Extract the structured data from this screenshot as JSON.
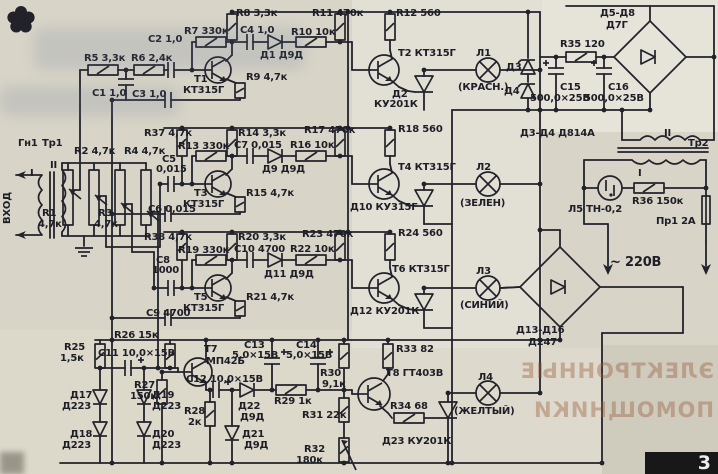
{
  "page": {
    "page_number": "3",
    "corner_icon": "flower-asterisk-icon",
    "paper_color": "#d8d4c7",
    "ink_color": "#22222b",
    "ghost": [
      "ЭЛЕКТРОННЫЕ",
      "ПОМОЩНИКИ"
    ]
  },
  "schematic": {
    "type": "hand-drawn color-music device circuit",
    "lamps": [
      {
        "name": "Л1",
        "color": "(КРАСН.)"
      },
      {
        "name": "Л2",
        "color": "(ЗЕЛЕН)"
      },
      {
        "name": "Л3",
        "color": "(СИНИЙ)"
      },
      {
        "name": "Л4",
        "color": "(ЖЕЛТЫЙ)"
      },
      {
        "name": "Л5",
        "type_label": "ТН-0,2"
      }
    ],
    "labels": [
      [
        "Гн1",
        18,
        146
      ],
      [
        "Тр1",
        42,
        146
      ],
      [
        "ВХОД",
        10,
        224,
        10,
        -90
      ],
      [
        "I",
        30,
        176
      ],
      [
        "II",
        50,
        168
      ],
      [
        "R1",
        42,
        216
      ],
      [
        "4,7к",
        38,
        227
      ],
      [
        "R2 4,7к",
        74,
        154
      ],
      [
        "R3",
        98,
        216
      ],
      [
        "4,7к",
        94,
        227
      ],
      [
        "R4 4,7к",
        124,
        154
      ],
      [
        "R5 3,3к",
        84,
        61
      ],
      [
        "R6 2,4к",
        131,
        61
      ],
      [
        "С1 1,0",
        92,
        96
      ],
      [
        "С2 1,0",
        148,
        42
      ],
      [
        "С3 1,0",
        132,
        97
      ],
      [
        "R7 330к",
        184,
        34
      ],
      [
        "Т1",
        194,
        82
      ],
      [
        "КТ315Г",
        183,
        93
      ],
      [
        "R8 3,3к",
        236,
        16
      ],
      [
        "С4 1,0",
        240,
        33
      ],
      [
        "Д1 Д9Д",
        260,
        58
      ],
      [
        "R10 10к",
        291,
        35
      ],
      [
        "R9 4,7к",
        246,
        80
      ],
      [
        "R11 470к",
        312,
        16
      ],
      [
        "R12 560",
        396,
        16
      ],
      [
        "Т2 КТ315Г",
        398,
        56
      ],
      [
        "Д2",
        392,
        97
      ],
      [
        "КУ201К",
        374,
        107
      ],
      [
        "Л1",
        476,
        56
      ],
      [
        "(КРАСН.)",
        458,
        90
      ],
      [
        "Д3",
        506,
        70
      ],
      [
        "Д4",
        504,
        94
      ],
      [
        "Д5-Д8",
        600,
        16
      ],
      [
        "Д7Г",
        606,
        28
      ],
      [
        "R35 120",
        560,
        47
      ],
      [
        "С15",
        560,
        90
      ],
      [
        "500,0×25В",
        530,
        101
      ],
      [
        "С16",
        608,
        90
      ],
      [
        "500,0×25В",
        584,
        101
      ],
      [
        "Д3-Д4 Д814А",
        520,
        136
      ],
      [
        "R37 4,7к",
        144,
        136
      ],
      [
        "R13 330к",
        178,
        149
      ],
      [
        "R14 3,3к",
        238,
        136
      ],
      [
        "С5",
        162,
        162
      ],
      [
        "0,015",
        156,
        172
      ],
      [
        "С7 0,015",
        234,
        148
      ],
      [
        "Д9 Д9Д",
        262,
        172
      ],
      [
        "R16 10к",
        290,
        148
      ],
      [
        "R17 470к",
        304,
        133
      ],
      [
        "R15 4,7к",
        246,
        196
      ],
      [
        "Т3",
        194,
        196
      ],
      [
        "КТ315Г",
        183,
        207
      ],
      [
        "С6 0,015",
        148,
        212
      ],
      [
        "R18 560",
        398,
        132
      ],
      [
        "Т4 КТ315Г",
        398,
        170
      ],
      [
        "Д10 КУ315Г",
        350,
        210
      ],
      [
        "Л2",
        476,
        170
      ],
      [
        "(ЗЕЛЕН)",
        460,
        206
      ],
      [
        "R38 4,7к",
        144,
        240
      ],
      [
        "R19 330к",
        178,
        253
      ],
      [
        "С8",
        156,
        263
      ],
      [
        "1000",
        152,
        273
      ],
      [
        "R20 3,3к",
        238,
        240
      ],
      [
        "С10 4700",
        234,
        252
      ],
      [
        "Д11 Д9Д",
        264,
        277
      ],
      [
        "R22 10к",
        290,
        252
      ],
      [
        "R23 470к",
        302,
        237
      ],
      [
        "R21 4,7к",
        246,
        300
      ],
      [
        "Т5",
        194,
        300
      ],
      [
        "КТ315Г",
        183,
        311
      ],
      [
        "С9 4700",
        146,
        316
      ],
      [
        "R24 560",
        398,
        236
      ],
      [
        "Т6 КТ315Г",
        392,
        272
      ],
      [
        "Д12 КУ201К",
        350,
        314
      ],
      [
        "Л3",
        476,
        274
      ],
      [
        "(СИНИЙ)",
        460,
        308
      ],
      [
        "Д13-Д16",
        516,
        333
      ],
      [
        "Д247",
        528,
        345
      ],
      [
        "~ 220В",
        610,
        266,
        13
      ],
      [
        "Тр2",
        688,
        146
      ],
      [
        "II",
        664,
        136
      ],
      [
        "I",
        638,
        176
      ],
      [
        "Л5 ТН-0,2",
        568,
        212
      ],
      [
        "R36 150к",
        632,
        204
      ],
      [
        "Пр1 2А",
        656,
        224
      ],
      [
        "R25",
        64,
        350
      ],
      [
        "1,5к",
        60,
        361
      ],
      [
        "R26 15к",
        114,
        338
      ],
      [
        "С11 10,0×15В",
        98,
        356
      ],
      [
        "Т7",
        204,
        352
      ],
      [
        "МП42Б",
        206,
        364
      ],
      [
        "R27",
        134,
        388
      ],
      [
        "150к",
        130,
        399
      ],
      [
        "С12 10,0×15В",
        186,
        382
      ],
      [
        "R28",
        184,
        414
      ],
      [
        "2к",
        188,
        425
      ],
      [
        "Д17",
        70,
        398
      ],
      [
        "Д223",
        62,
        409
      ],
      [
        "Д19",
        152,
        398
      ],
      [
        "Д223",
        152,
        409
      ],
      [
        "Д18",
        70,
        437
      ],
      [
        "Д223",
        62,
        448
      ],
      [
        "Д20",
        152,
        437
      ],
      [
        "Д223",
        152,
        448
      ],
      [
        "Д22",
        238,
        409
      ],
      [
        "Д9Д",
        240,
        420
      ],
      [
        "Д21",
        242,
        437
      ],
      [
        "Д9Д",
        244,
        448
      ],
      [
        "R29 1к",
        274,
        404
      ],
      [
        "С13",
        244,
        348
      ],
      [
        "5,0×15В",
        232,
        358
      ],
      [
        "С14",
        296,
        348
      ],
      [
        "5,0×15В",
        286,
        358
      ],
      [
        "R30",
        320,
        376
      ],
      [
        "9,1к",
        322,
        387
      ],
      [
        "R31 22к",
        302,
        418
      ],
      [
        "R32",
        304,
        452
      ],
      [
        "180к",
        296,
        463
      ],
      [
        "R33 82",
        396,
        352
      ],
      [
        "Т8 ГТ403В",
        386,
        376
      ],
      [
        "R34 68",
        390,
        409
      ],
      [
        "Д23 КУ201К",
        382,
        444
      ],
      [
        "Л4",
        478,
        380
      ],
      [
        "(ЖЕЛТЫЙ)",
        454,
        414
      ]
    ]
  }
}
